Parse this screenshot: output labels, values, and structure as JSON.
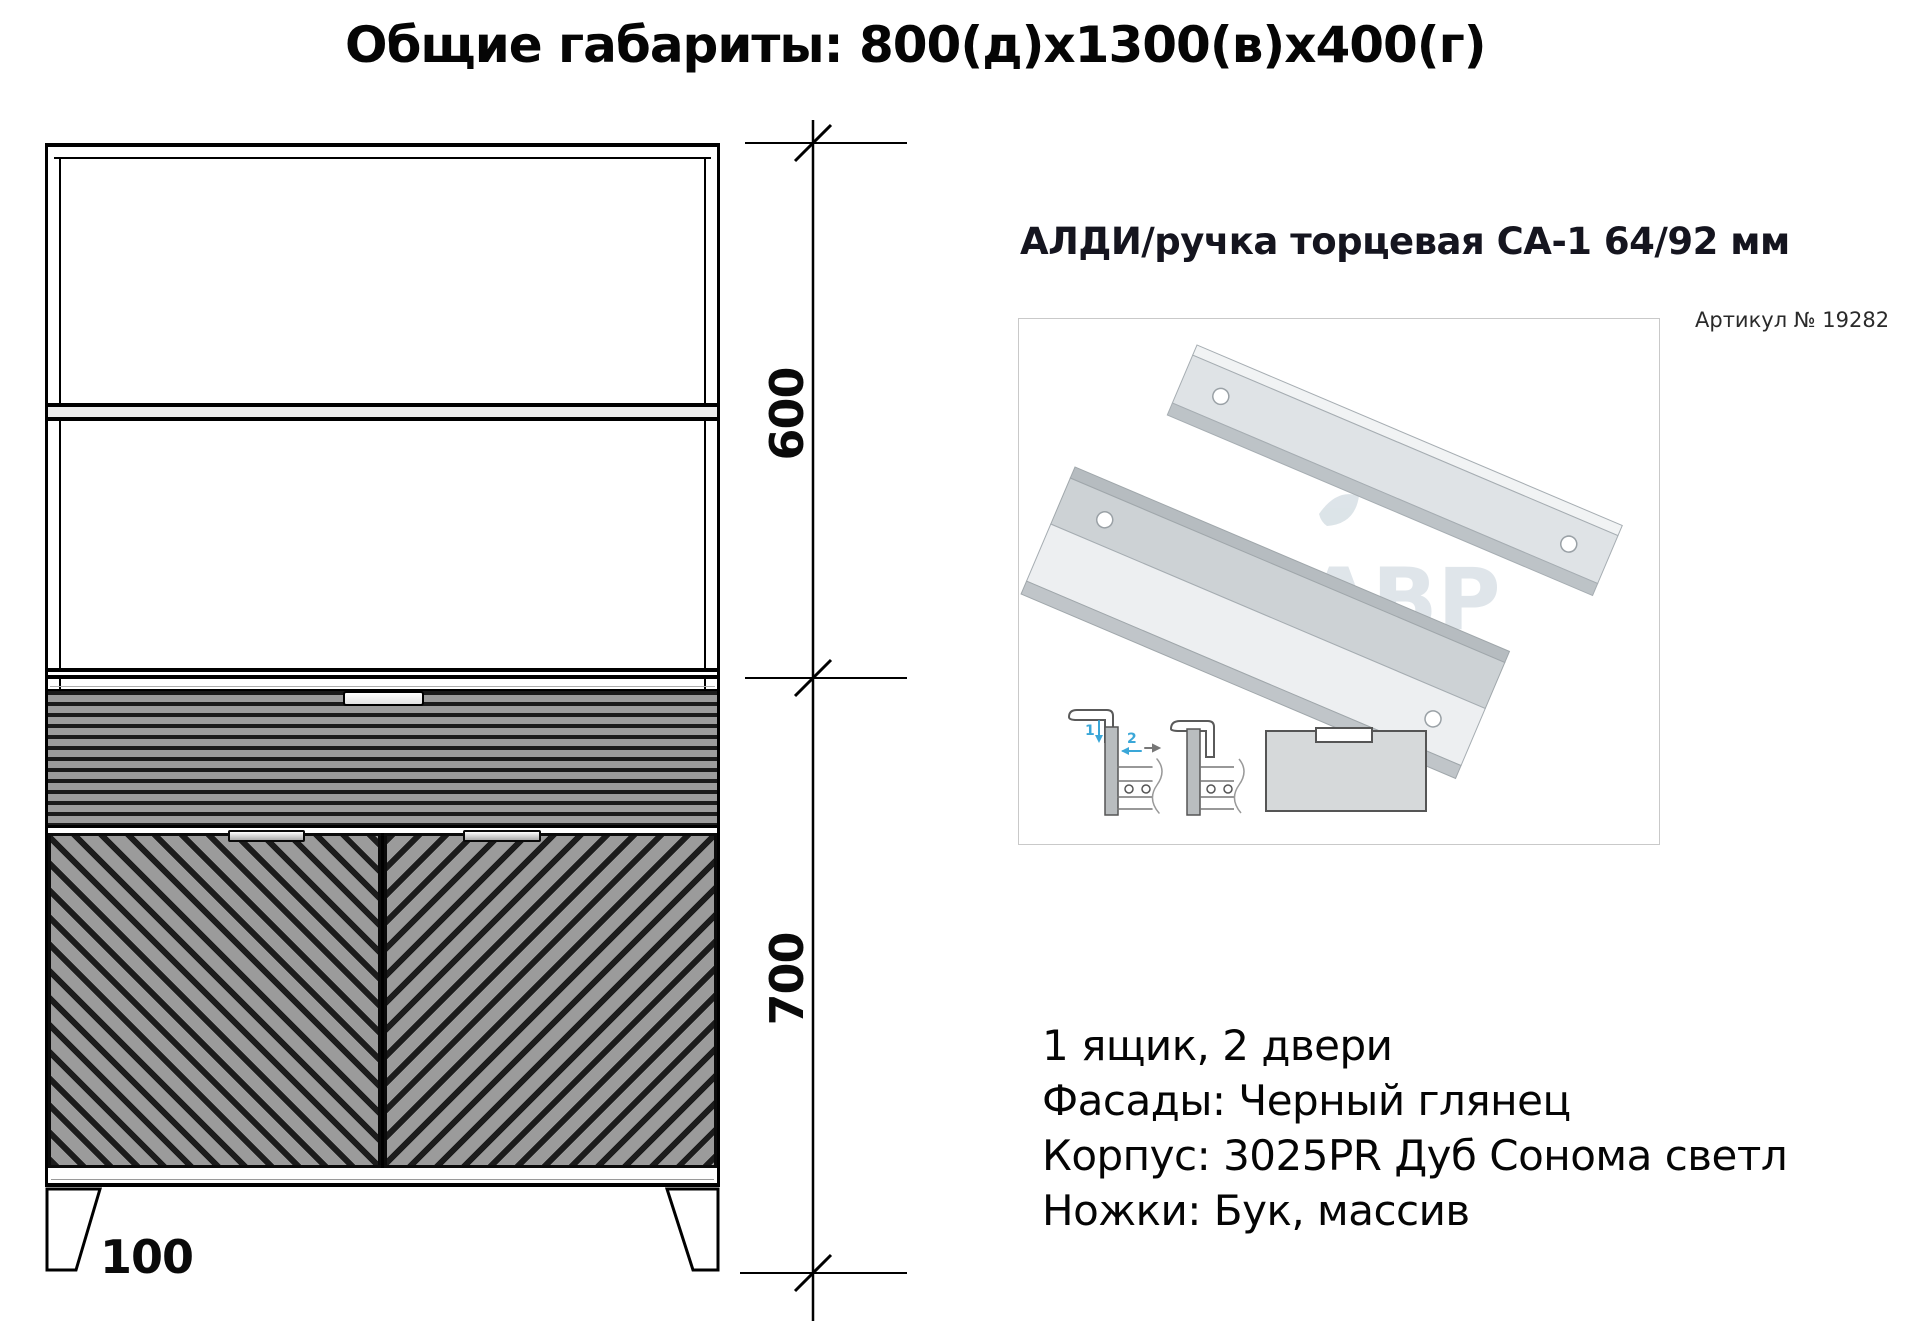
{
  "page_title": "Общие габариты: 800(д)x1300(в)x400(г)",
  "drawing": {
    "dim_upper": "600",
    "dim_lower": "700",
    "dim_foot": "100"
  },
  "product": {
    "title": "АЛДИ/ручка торцевая СА-1 64/92 мм",
    "sku": "Артикул № 19282",
    "watermark": "ЛАВР",
    "install_steps": [
      "1",
      "2"
    ]
  },
  "specs": {
    "lines": [
      "1 ящик, 2 двери",
      "Фасады: Черный глянец",
      "Корпус: 3025PR Дуб Сонома светл",
      "Ножки: Бук, массив"
    ]
  },
  "colors": {
    "accent_blue": "#3aa7d8",
    "facade_gray": "#9b9b9b",
    "line_black": "#0a0a0a",
    "aluminum_light": "#e4e8ea",
    "aluminum_mid": "#cdd2d5"
  }
}
